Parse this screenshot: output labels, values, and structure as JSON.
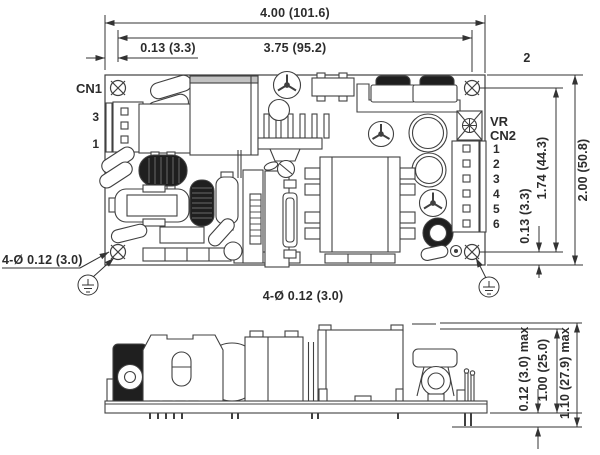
{
  "top_view": {
    "dims": {
      "overall_width": "4.00 (101.6)",
      "hole_pitch_x": "3.75 (95.2)",
      "hole_offset_x": "0.13 (3.3)",
      "overall_height": "2.00 (50.8)",
      "hole_pitch_y": "1.74 (44.3)",
      "hole_offset_y": "0.13 (3.3)",
      "mounting_holes_callout": "4-Ø 0.12 (3.0)",
      "mounting_holes_note": "4-Ø 0.12 (3.0)",
      "note_ref": "2"
    },
    "labels": {
      "cn1": "CN1",
      "cn1_pin_top": "3",
      "cn1_pin_bottom": "1",
      "vr": "VR",
      "cn2": "CN2",
      "cn2_pins": [
        "1",
        "2",
        "3",
        "4",
        "5",
        "6"
      ]
    }
  },
  "side_view": {
    "dims": {
      "pin_protrusion": "0.12 (3.0) max",
      "component_height": "1.00 (25.0)",
      "overall_height": "1.10 (27.9) max"
    }
  },
  "colors": {
    "line": "#404040",
    "dim_line": "#333333",
    "dark_fill": "#1f1f1f",
    "shade": "#c2c2c2"
  }
}
